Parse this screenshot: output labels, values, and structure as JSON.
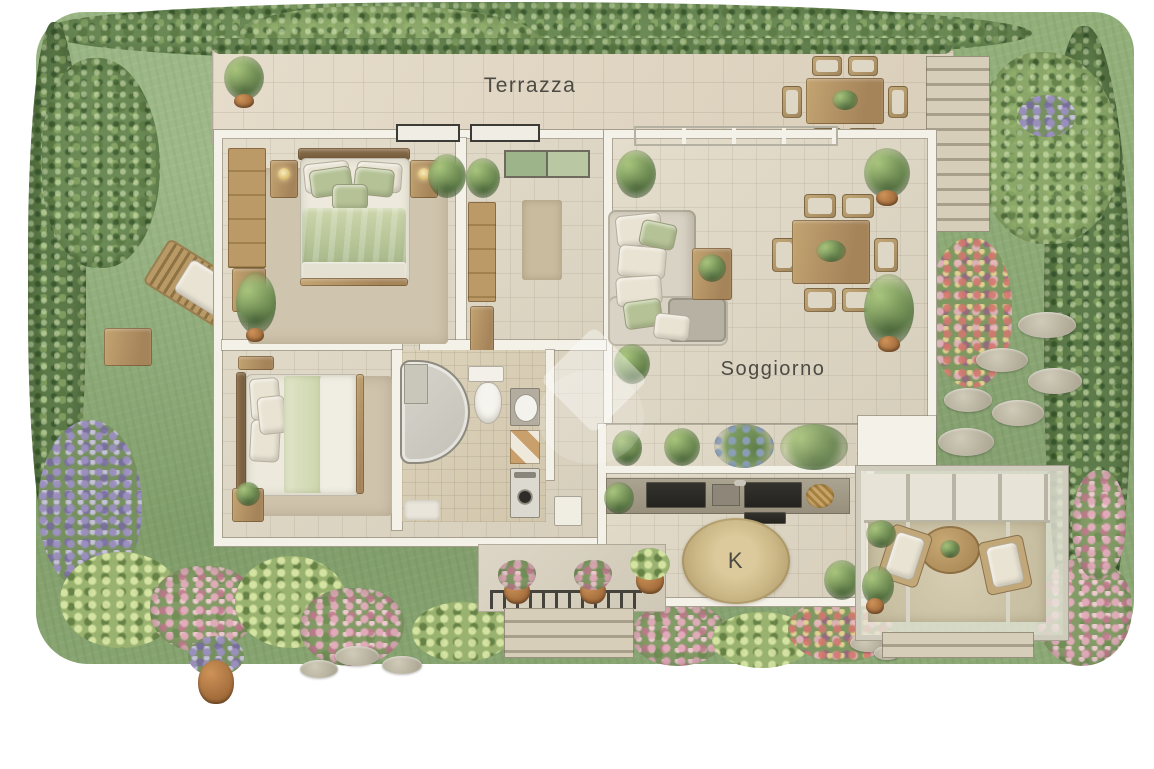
{
  "labels": {
    "terrace": "Terrazza",
    "living_room": "Soggiorno",
    "kitchen": "K"
  },
  "palette": {
    "grass": "#93b07c",
    "hedge": "#6b8a55",
    "interior_tile": "#ddd5c3",
    "terrace_tile": "#e0d7c6",
    "wall": "#f4f1e8",
    "wood": "#b3956a",
    "bedding_green": "#b9c69c",
    "upholstery": "#ddd7c9",
    "kitchen_counter": "#a59e90",
    "appliance_dark": "#2b2a26",
    "round_rug": "#cbb98b",
    "flower_pink": "#d39fae",
    "terracotta": "#b5713f",
    "stepping_stone": "#bdb6a5",
    "label_text": "#4b4b44"
  }
}
